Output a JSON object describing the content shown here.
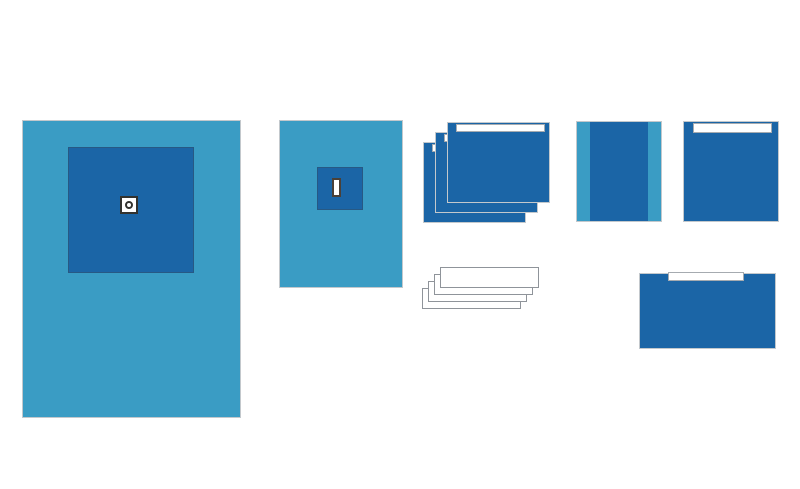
{
  "canvas": {
    "width": 800,
    "height": 489,
    "background": "#FFFFFF"
  },
  "palette": {
    "canvas_bg": "#FFFFFF",
    "drape_light": "#3A9CC4",
    "drape_dark": "#1B65A6",
    "tape_white": "#FFFFFF",
    "edge_gray": "#C3C8CC",
    "tape_border": "#A6ABB0",
    "towel_border": "#8F949A",
    "icon_outline": "#32322F",
    "slot_outline": "#4A4038"
  },
  "items": [
    {
      "id": "large-fenestrated-drape",
      "shape": "portrait-rectangle",
      "fenestration": "round-hole",
      "count": 1
    },
    {
      "id": "small-fenestrated-drape",
      "shape": "portrait-rectangle",
      "fenestration": "rectangular-slot",
      "count": 1
    },
    {
      "id": "adhesive-side-drape-stack",
      "shape": "landscape-rectangle-with-tape-strip",
      "count": 3
    },
    {
      "id": "side-band-drape",
      "shape": "rectangle-with-light-side-bands",
      "count": 1
    },
    {
      "id": "adhesive-drape",
      "shape": "square-with-tape-strip",
      "count": 1
    },
    {
      "id": "towel-stack",
      "shape": "thin-white-rectangle",
      "count": 4
    },
    {
      "id": "wide-adhesive-drape",
      "shape": "landscape-rectangle-with-tape-strip",
      "count": 1
    }
  ]
}
